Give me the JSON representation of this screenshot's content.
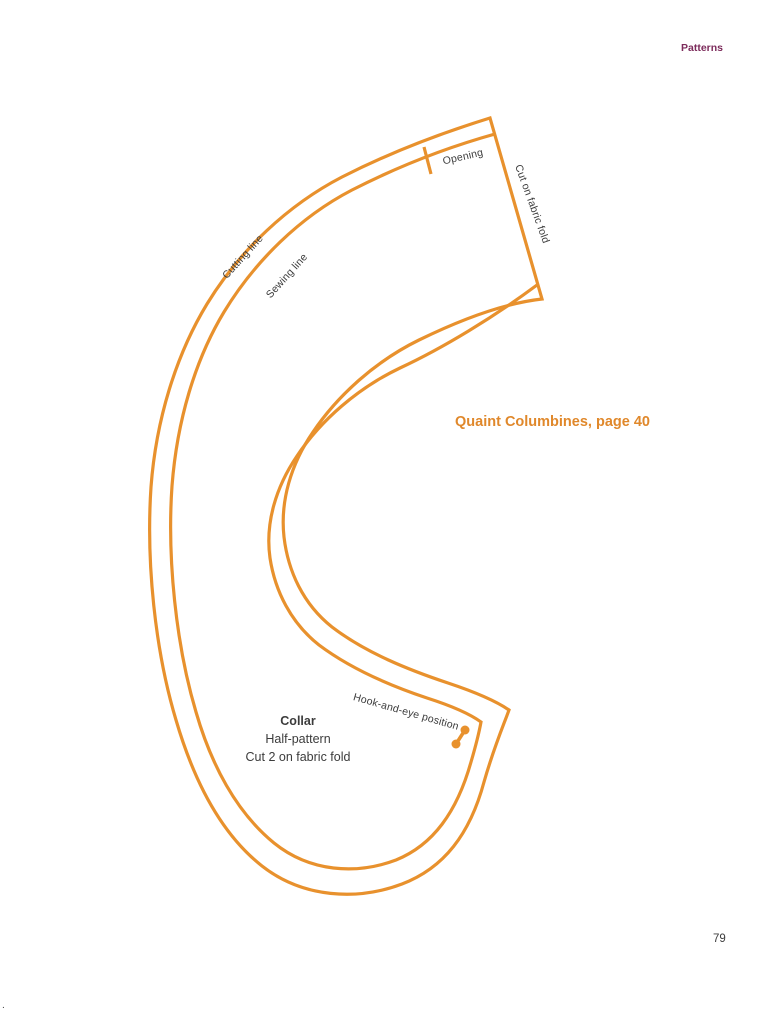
{
  "page": {
    "header_label": "Patterns",
    "caption": "Quaint Columbines, page 40",
    "page_number": "79",
    "corner_mark": "."
  },
  "pattern": {
    "labels": {
      "cutting_line": "Cutting line",
      "sewing_line": "Sewing line",
      "opening": "Opening",
      "fold_edge": "Cut on fabric fold",
      "hook_eye": "Hook-and-eye position"
    },
    "info": {
      "name": "Collar",
      "line2": "Half-pattern",
      "line3": "Cut 2 on fabric fold"
    }
  },
  "colors": {
    "pattern_line": "#e8912d",
    "header": "#7c2b5b",
    "caption": "#e0882b",
    "text": "#3c3c3c"
  }
}
